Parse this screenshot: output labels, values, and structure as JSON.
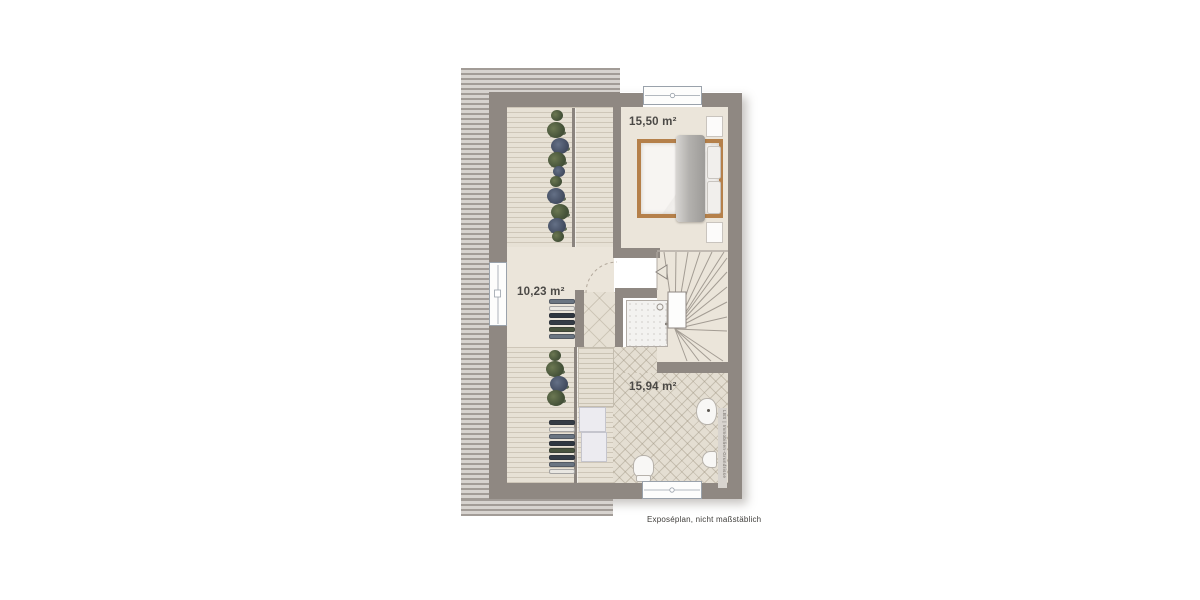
{
  "colors": {
    "wall": "#8f8882",
    "floor": "#ebe5da",
    "deck": "#e7e1d5",
    "hatch-dark": "#a29c97",
    "hatch-light": "#d7d3cf",
    "tile": "#e4ded2",
    "bed-frame": "#b5804a",
    "plant": "#47543a",
    "label": "#4b4946"
  },
  "floorplan": {
    "rooms": [
      {
        "id": "bedroom",
        "area_label": "15,50 m²"
      },
      {
        "id": "attic-room",
        "area_label": "10,23 m²"
      },
      {
        "id": "bathroom",
        "area_label": "15,94 m²"
      }
    ]
  },
  "footer": {
    "caption": "Exposéplan, nicht maßstäblich"
  },
  "watermark": {
    "text": "LBS | Immobilien-Grundrisse"
  }
}
